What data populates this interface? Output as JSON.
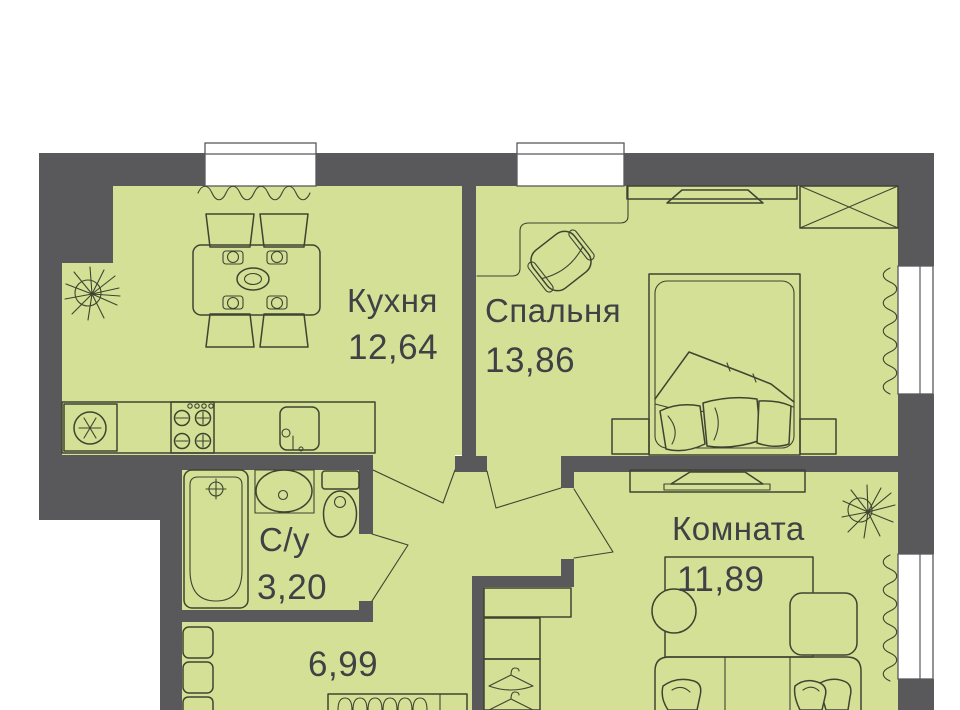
{
  "plan_type": "apartment floor plan",
  "colors": {
    "wall": "#59595c",
    "floor": "#d3e096",
    "line": "#3f4431",
    "text": "#3f4145",
    "background": "#ffffff"
  },
  "rooms": {
    "kitchen": {
      "name": "Кухня",
      "area": "12,64"
    },
    "bedroom": {
      "name": "Спальня",
      "area": "13,86"
    },
    "bathroom": {
      "name": "С/у",
      "area": "3,20"
    },
    "hallway": {
      "area": "6,99"
    },
    "room": {
      "name": "Комната",
      "area": "11,89"
    }
  }
}
